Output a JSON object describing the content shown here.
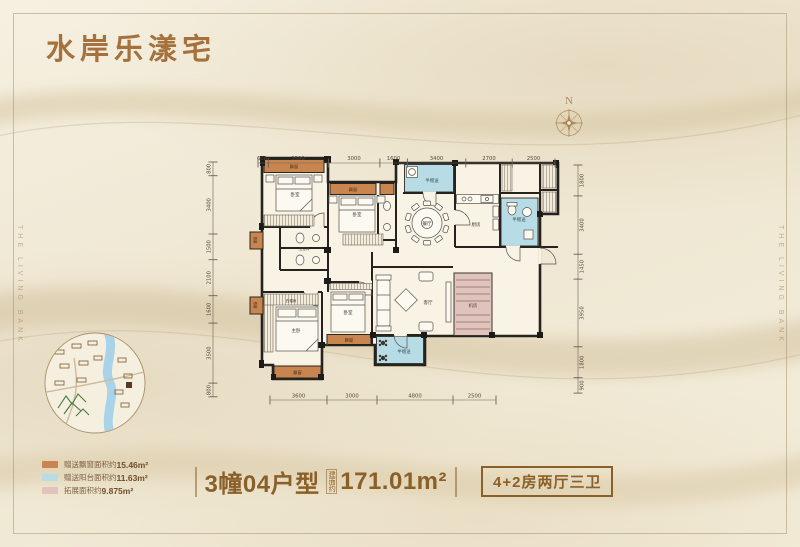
{
  "title": "水岸乐漾宅",
  "side_text": "THE LIVING BANK",
  "compass": {
    "label": "N"
  },
  "plan": {
    "labels": {
      "bay": "飘窗",
      "half_gift": "半赠送",
      "bedroom": "卧室",
      "master_bedroom": "主卧",
      "living_room": "客厅",
      "dining_room": "餐厅",
      "kitchen": "厨房",
      "bathroom": "卫生间",
      "equipment_room": "机房",
      "cloakroom": "衣帽间"
    },
    "dims": {
      "top": [
        "600",
        "3500",
        "3000",
        "1600",
        "3400",
        "2700",
        "2500"
      ],
      "bottom": [
        "3600",
        "3000",
        "4800",
        "2500"
      ],
      "left": [
        "800",
        "3400",
        "1500",
        "2100",
        "1600",
        "3500",
        "800"
      ],
      "right": [
        "1800",
        "3400",
        "1450",
        "3950",
        "1800",
        "900"
      ]
    }
  },
  "legend": {
    "items": [
      {
        "label": "赠送飘窗面积约",
        "value": "15.46m²",
        "color": "#c9854f"
      },
      {
        "label": "赠送阳台面积约",
        "value": "11.63m²",
        "color": "#b8dce6"
      },
      {
        "label": "拓展面积约",
        "value": "9.875m²",
        "color": "#e0c3bc"
      }
    ]
  },
  "footer": {
    "unit": "3幢04户型",
    "area_note": "建面约",
    "area": "171.01m²",
    "spec": "4+2房两厅三卫"
  }
}
